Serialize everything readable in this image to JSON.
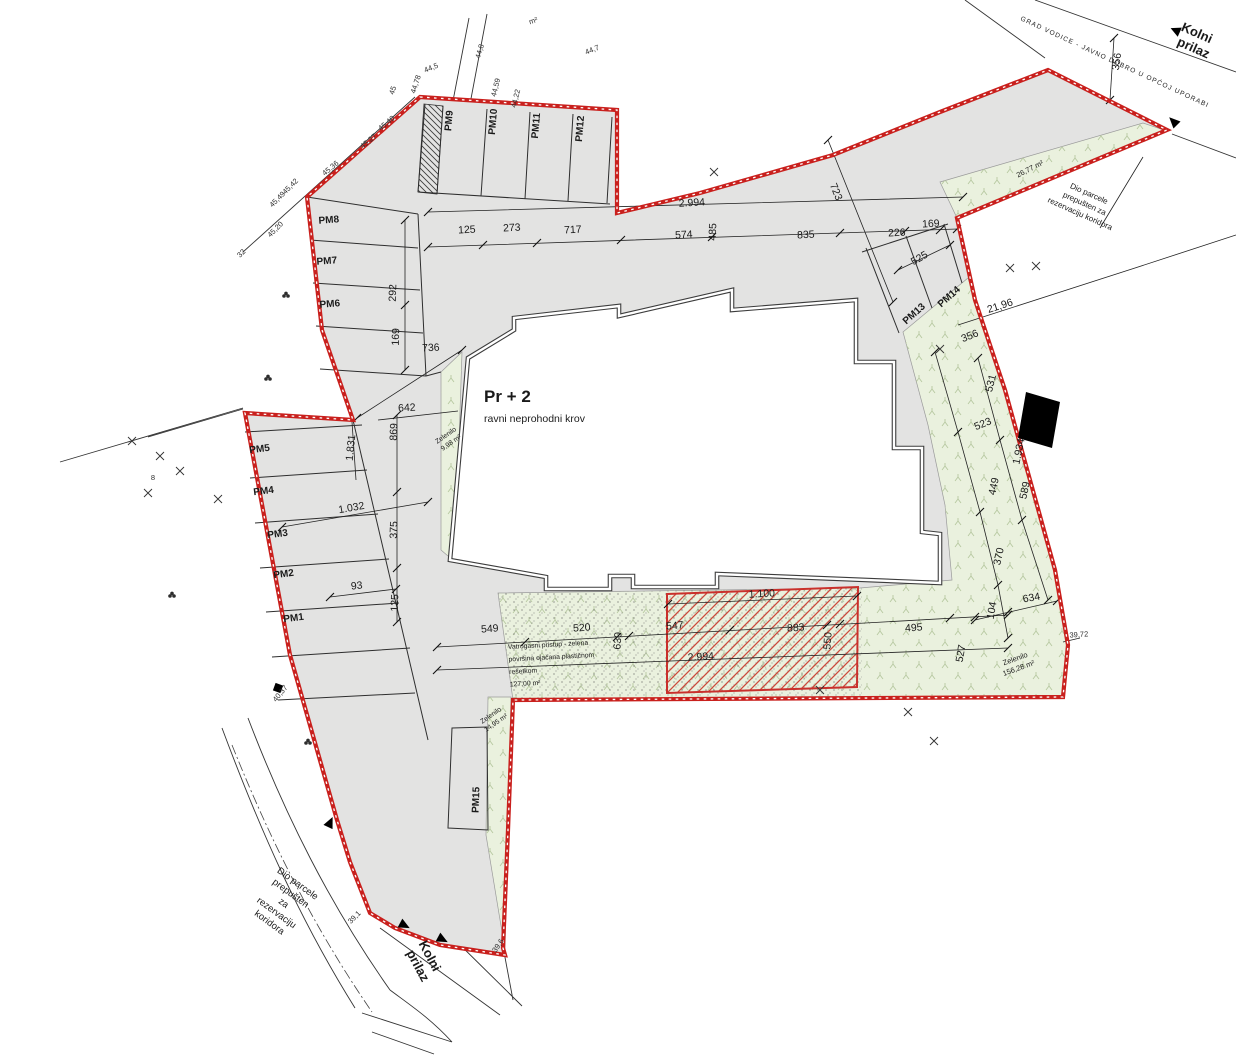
{
  "colors": {
    "boundary_red": "#c9201d",
    "paved_gray": "#e3e3e2",
    "green_fill": "#eaf1de",
    "hatch_red": "#cc4a3c",
    "building_outline": "#3c3c3c"
  },
  "building": {
    "floors": "Pr + 2",
    "roof_note": "ravni neprohodni krov"
  },
  "notes": {
    "fire_access": {
      "line1": "Vatrogasni pristup - zelena",
      "line2": "površina ojačana plastičnom",
      "line3": "rešetkom",
      "line4": "127,00 m²"
    },
    "corridor_top": {
      "line1": "Dio parcele",
      "line2": "prepušten za",
      "line3": "rezervaciju koridora"
    },
    "corridor_bottom": {
      "line1": "Dio parcele",
      "line2": "prepušten",
      "line3": "za",
      "line4": "rezervaciju",
      "line5": "koridora"
    },
    "access_top": {
      "line1": "Kolni",
      "line2": "prilaz"
    },
    "access_bottom": {
      "line1": "Kolni",
      "line2": "prilaz"
    },
    "road_ownership": "GRAD VODICE - JAVNO DOBRO U OPĆOJ UPORABI"
  },
  "areas": {
    "green_left": {
      "name": "Zelenilo",
      "value": "9,98 m²"
    },
    "green_pm15": {
      "name": "Zelenilo",
      "value": "14,95 m²"
    },
    "green_right": {
      "name": "Zelenilo",
      "value": "156,28 m²"
    },
    "green_corridor": {
      "value": "26,77 m²"
    }
  },
  "dimension_labels": [
    {
      "t": "125",
      "x": 467,
      "y": 233,
      "r": -3
    },
    {
      "t": "273",
      "x": 512,
      "y": 231,
      "r": -3
    },
    {
      "t": "717",
      "x": 573,
      "y": 233,
      "r": -3
    },
    {
      "t": "574",
      "x": 684,
      "y": 238,
      "r": -3
    },
    {
      "t": "485",
      "x": 716,
      "y": 232,
      "r": -88
    },
    {
      "t": "835",
      "x": 806,
      "y": 238,
      "r": -3
    },
    {
      "t": "226",
      "x": 897,
      "y": 236,
      "r": -3
    },
    {
      "t": "169",
      "x": 931,
      "y": 227,
      "r": -3
    },
    {
      "t": "2.994",
      "x": 692,
      "y": 206,
      "r": -3
    },
    {
      "t": "723",
      "x": 833,
      "y": 193,
      "r": 68
    },
    {
      "t": "525",
      "x": 921,
      "y": 261,
      "r": -30
    },
    {
      "t": "292",
      "x": 396,
      "y": 293,
      "r": -88
    },
    {
      "t": "169",
      "x": 399,
      "y": 337,
      "r": -88
    },
    {
      "t": "736",
      "x": 431,
      "y": 351,
      "r": -3
    },
    {
      "t": "642",
      "x": 407,
      "y": 411,
      "r": -3
    },
    {
      "t": "869",
      "x": 397,
      "y": 432,
      "r": -88
    },
    {
      "t": "1.831",
      "x": 354,
      "y": 448,
      "r": -84
    },
    {
      "t": "1.032",
      "x": 352,
      "y": 511,
      "r": -10
    },
    {
      "t": "375",
      "x": 397,
      "y": 530,
      "r": -88
    },
    {
      "t": "93",
      "x": 357,
      "y": 589,
      "r": -6
    },
    {
      "t": "125",
      "x": 398,
      "y": 603,
      "r": -88
    },
    {
      "t": "356",
      "x": 971,
      "y": 339,
      "r": -22
    },
    {
      "t": "531",
      "x": 994,
      "y": 384,
      "r": -76
    },
    {
      "t": "523",
      "x": 984,
      "y": 427,
      "r": -22
    },
    {
      "t": "1.934",
      "x": 1022,
      "y": 452,
      "r": -78
    },
    {
      "t": "449",
      "x": 997,
      "y": 487,
      "r": -78
    },
    {
      "t": "589",
      "x": 1028,
      "y": 491,
      "r": -78
    },
    {
      "t": "370",
      "x": 1002,
      "y": 557,
      "r": -78
    },
    {
      "t": "104",
      "x": 995,
      "y": 611,
      "r": -80
    },
    {
      "t": "634",
      "x": 1032,
      "y": 601,
      "r": -10
    },
    {
      "t": "527",
      "x": 964,
      "y": 654,
      "r": -80
    },
    {
      "t": "495",
      "x": 914,
      "y": 631,
      "r": -4
    },
    {
      "t": "21,96",
      "x": 1001,
      "y": 309,
      "r": -18
    },
    {
      "t": "356",
      "x": 1120,
      "y": 62,
      "r": -82
    },
    {
      "t": "549",
      "x": 490,
      "y": 632,
      "r": -4
    },
    {
      "t": "520",
      "x": 582,
      "y": 631,
      "r": -4
    },
    {
      "t": "630",
      "x": 621,
      "y": 641,
      "r": -86
    },
    {
      "t": "547",
      "x": 675,
      "y": 629,
      "r": -4
    },
    {
      "t": "883",
      "x": 796,
      "y": 631,
      "r": -4
    },
    {
      "t": "550",
      "x": 831,
      "y": 641,
      "r": -86
    },
    {
      "t": "1.100",
      "x": 762,
      "y": 597,
      "r": -3
    },
    {
      "t": "2.994",
      "x": 701,
      "y": 660,
      "r": -3
    }
  ],
  "parking_labels": [
    {
      "t": "PM1",
      "x": 294,
      "y": 621,
      "r": -7
    },
    {
      "t": "PM2",
      "x": 284,
      "y": 577,
      "r": -7
    },
    {
      "t": "PM3",
      "x": 278,
      "y": 537,
      "r": -7
    },
    {
      "t": "PM4",
      "x": 264,
      "y": 494,
      "r": -7
    },
    {
      "t": "PM5",
      "x": 260,
      "y": 452,
      "r": -7
    },
    {
      "t": "PM6",
      "x": 330,
      "y": 307,
      "r": -4
    },
    {
      "t": "PM7",
      "x": 327,
      "y": 264,
      "r": -4
    },
    {
      "t": "PM8",
      "x": 329,
      "y": 223,
      "r": -4
    },
    {
      "t": "PM9",
      "x": 452,
      "y": 121,
      "r": -85
    },
    {
      "t": "PM10",
      "x": 496,
      "y": 122,
      "r": -85
    },
    {
      "t": "PM11",
      "x": 539,
      "y": 126,
      "r": -85
    },
    {
      "t": "PM12",
      "x": 583,
      "y": 129,
      "r": -85
    },
    {
      "t": "PM13",
      "x": 916,
      "y": 316,
      "r": -42
    },
    {
      "t": "PM14",
      "x": 951,
      "y": 299,
      "r": -42
    },
    {
      "t": "PM15",
      "x": 479,
      "y": 800,
      "r": -88
    }
  ],
  "elevation_labels": [
    {
      "t": "45,20",
      "x": 277,
      "y": 231,
      "r": -45
    },
    {
      "t": "45,49",
      "x": 279,
      "y": 201,
      "r": -45
    },
    {
      "t": "45,42",
      "x": 292,
      "y": 188,
      "r": -45
    },
    {
      "t": "45,36",
      "x": 332,
      "y": 170,
      "r": -40
    },
    {
      "t": "45,27",
      "x": 370,
      "y": 143,
      "r": -40
    },
    {
      "t": "45,40",
      "x": 388,
      "y": 125,
      "r": -40
    },
    {
      "t": "45",
      "x": 395,
      "y": 91,
      "r": -72
    },
    {
      "t": "44,78",
      "x": 418,
      "y": 85,
      "r": -72
    },
    {
      "t": "44,8",
      "x": 482,
      "y": 52,
      "r": -74
    },
    {
      "t": "44,59",
      "x": 498,
      "y": 88,
      "r": -76
    },
    {
      "t": "44,22",
      "x": 518,
      "y": 99,
      "r": -76
    },
    {
      "t": "44,5",
      "x": 432,
      "y": 70,
      "r": -22
    },
    {
      "t": "44,7",
      "x": 593,
      "y": 52,
      "r": -22
    },
    {
      "t": "m²",
      "x": 534,
      "y": 23,
      "r": -18
    },
    {
      "t": "32",
      "x": 243,
      "y": 255,
      "r": -45
    },
    {
      "t": "40,37",
      "x": 282,
      "y": 695,
      "r": -50
    },
    {
      "t": "39,1",
      "x": 356,
      "y": 919,
      "r": -45
    },
    {
      "t": "39,6",
      "x": 500,
      "y": 947,
      "r": -55
    },
    {
      "t": "39,72",
      "x": 1079,
      "y": 637,
      "r": -4
    },
    {
      "t": "8",
      "x": 153,
      "y": 480,
      "r": 0
    }
  ]
}
